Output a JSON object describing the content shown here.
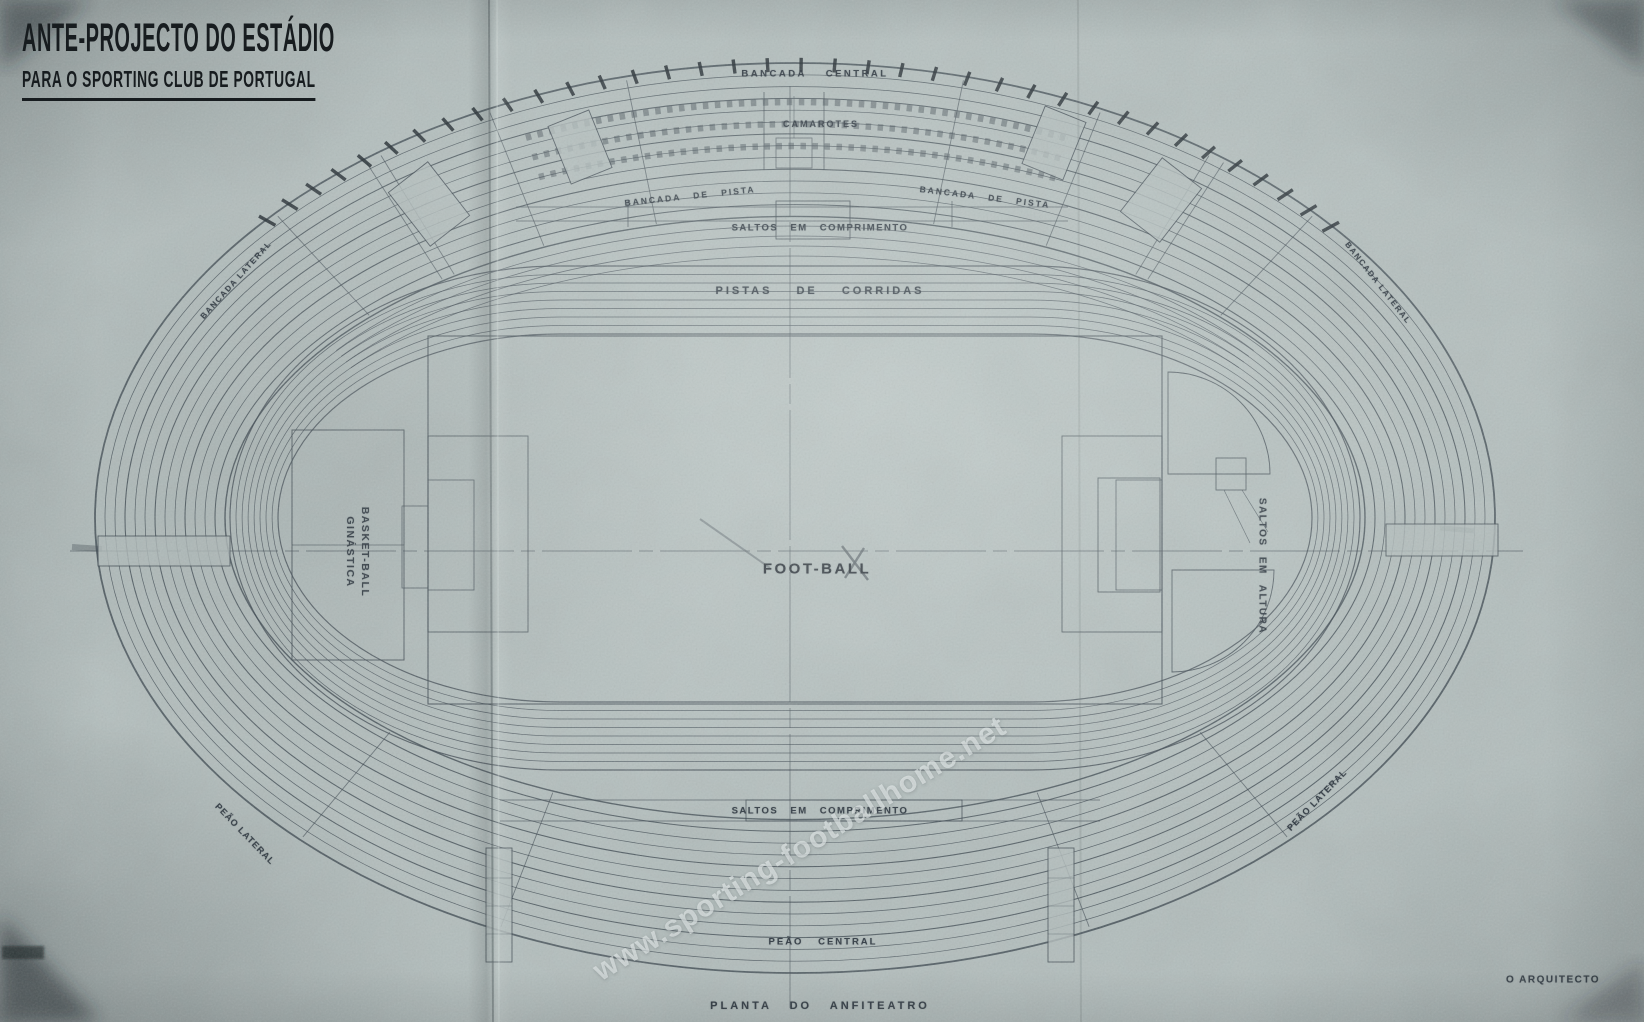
{
  "title": {
    "line1": "ANTE-PROJECTO DO ESTÁDIO",
    "line2": "PARA O SPORTING CLUB DE PORTUGAL"
  },
  "plan_labels": {
    "bancada_central": "BANCADA CENTRAL",
    "camarotes": "CAMAROTES",
    "bancada_de_pista_left": "BANCADA DE PISTA",
    "bancada_de_pista_right": "BANCADA DE PISTA",
    "bancada_lateral_left": "BANCADA LATERAL",
    "bancada_lateral_right": "BANCADA LATERAL",
    "saltos_em_comprimento_top": "SALTOS EM COMPRIMENTO",
    "pistas_de_corridas": "PISTAS DE CORRIDAS",
    "foot_ball": "FOOT-BALL",
    "basket_ball": "BASKET-BALL",
    "ginastica": "GINÁSTICA",
    "saltos_em_altura": "SALTOS EM ALTURA",
    "saltos_em_comprimento_bottom": "SALTOS EM COMPRIMENTO",
    "peao_lateral_left": "PEÃO LATERAL",
    "peao_lateral_right": "PEÃO LATERAL",
    "peao_central": "PEÃO CENTRAL",
    "planta_do_anfiteatro": "PLANTA DO ANFITEATRO",
    "o_arquitecto": "O ARQUITECTO"
  },
  "watermark": {
    "text": "www.sporting-footballhome.net"
  },
  "colors": {
    "paper": "#b2bdbc",
    "ink": "#37424b",
    "tick": "#1d262c",
    "pencil": "#4d575e",
    "fold": "#4c585a",
    "fold_highlight": "#dde6e3",
    "shadow": "#262e30",
    "mark": "#14181a",
    "watermark": "#edf4f3",
    "title_ink": "#171c1f",
    "label_ink": "#1f2933"
  }
}
